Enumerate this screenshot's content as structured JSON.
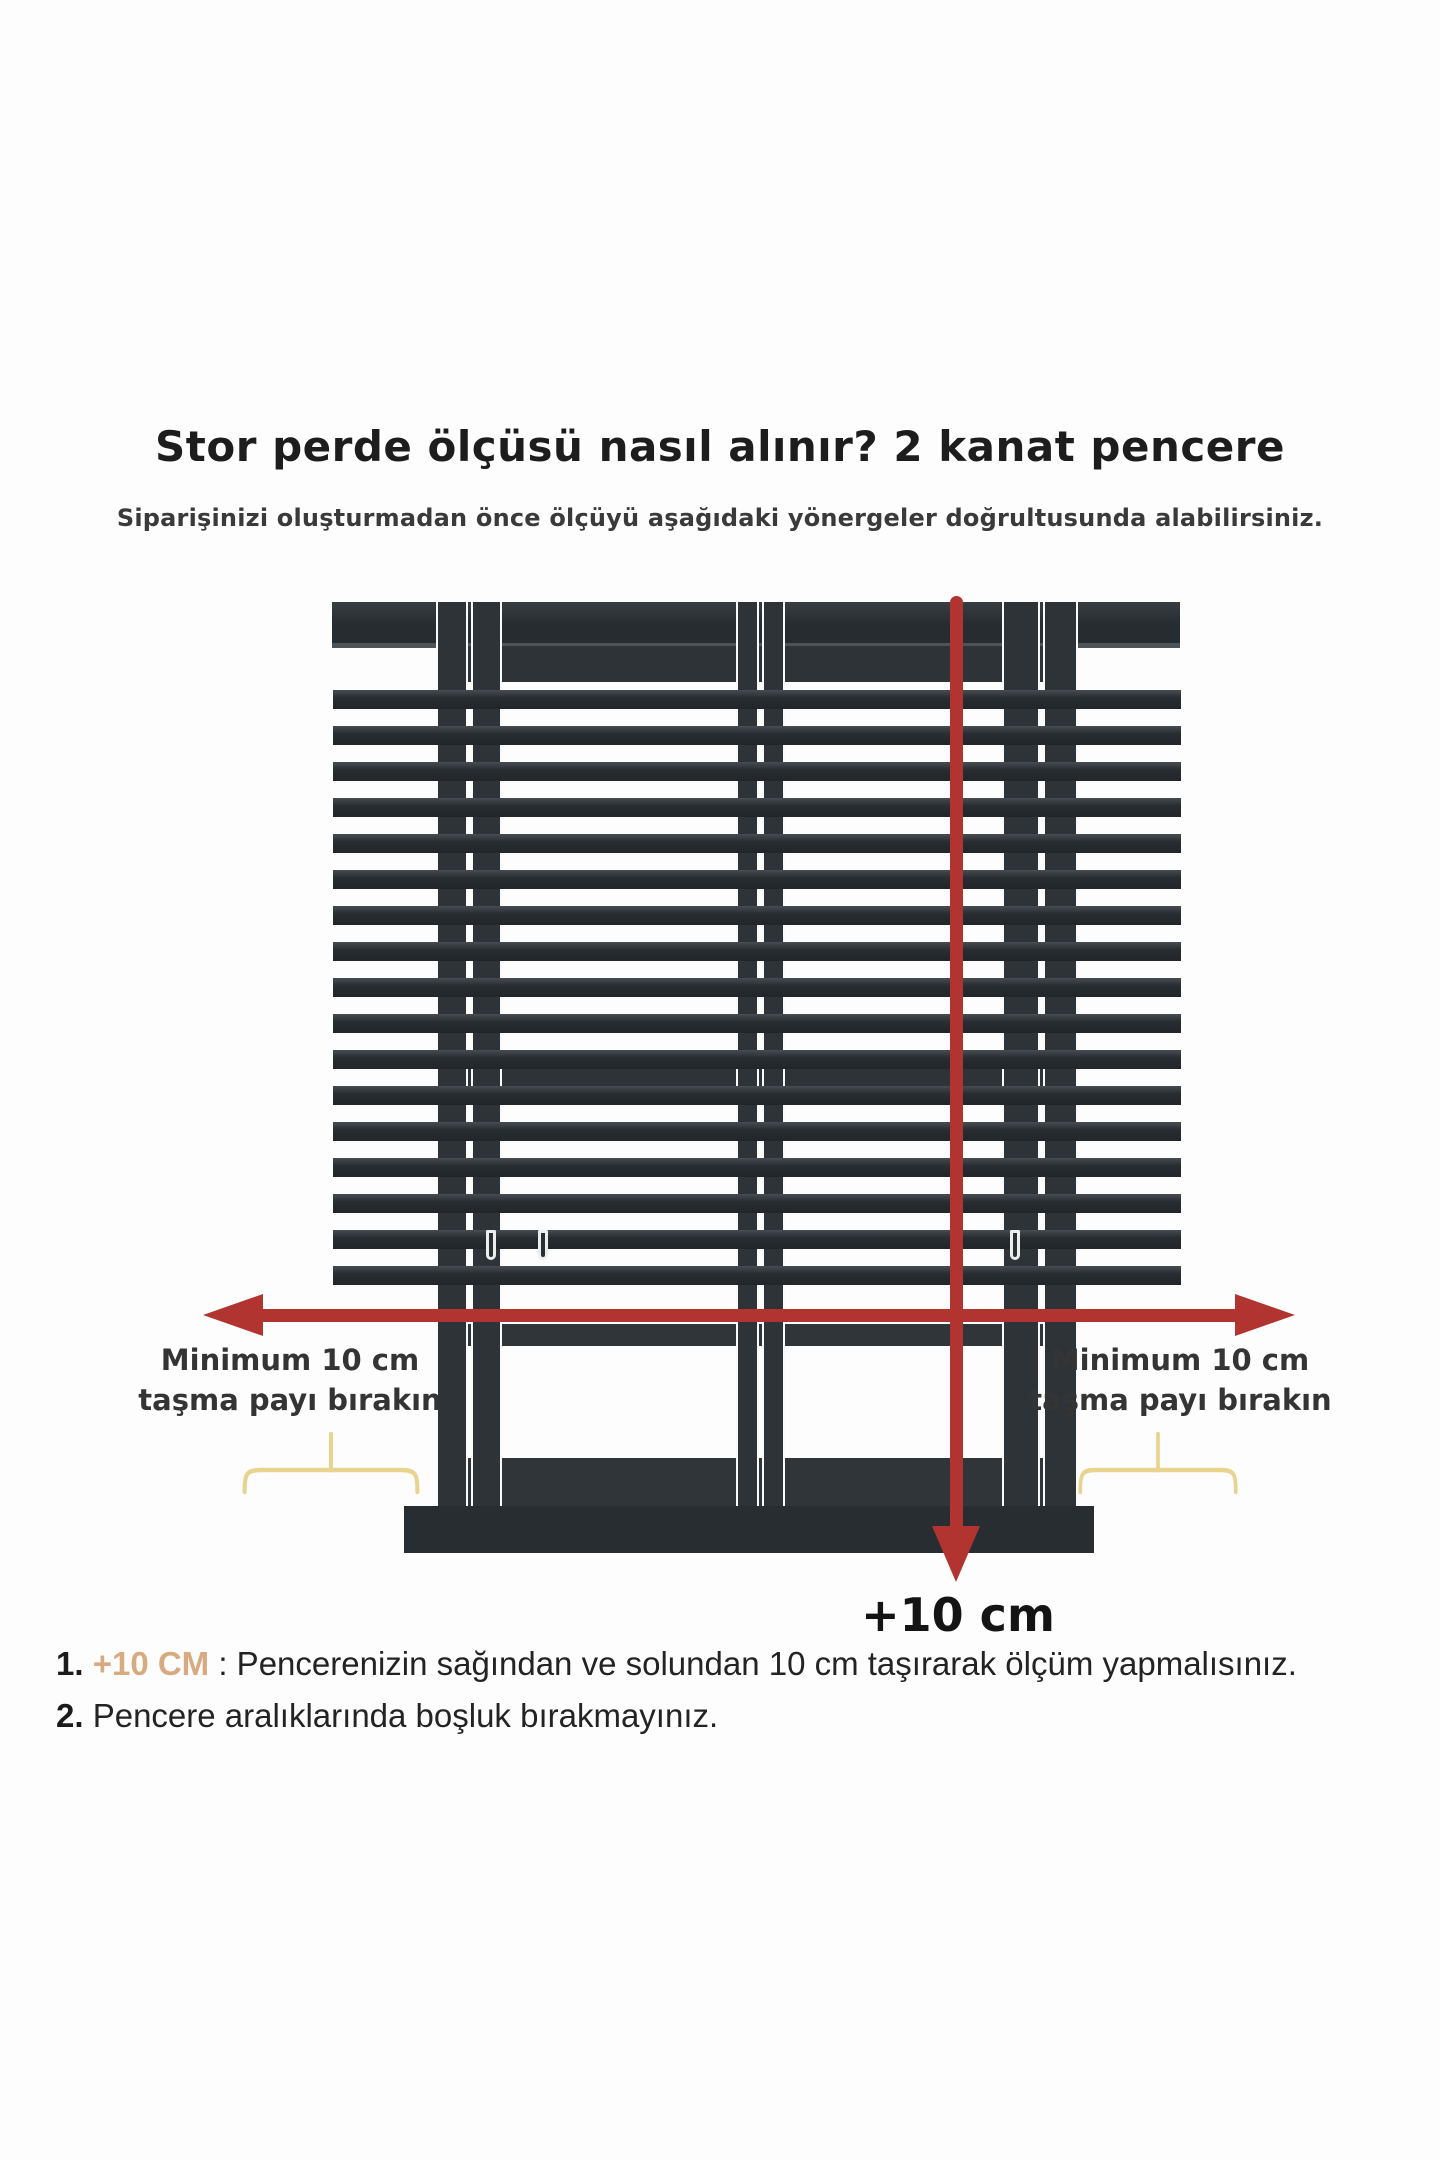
{
  "header": {
    "title": "Stor perde ölçüsü nasıl alınır? 2 kanat pencere",
    "subtitle": "Siparişinizi oluşturmadan önce ölçüyü aşağıdaki yönergeler doğrultusunda alabilirsiniz."
  },
  "diagram": {
    "left_label": {
      "line1": "Minimum 10 cm",
      "line2": "taşma payı bırakın"
    },
    "right_label": {
      "line1": "Minimum 10 cm",
      "line2": "taşma payı bırakın"
    },
    "bottom_arrow_label": "+10 cm",
    "colors": {
      "blind_dark": "#282d31",
      "frame_dark": "#2e3337",
      "red": "#b13430",
      "brace_yellow": "#e8d38f",
      "note_highlight": "#d8aa7f",
      "text_primary": "#1d1d1d",
      "text_secondary": "#3a3a3a"
    }
  },
  "notes": [
    {
      "number": "1.",
      "highlight": "+10 CM",
      "text": " : Pencerenizin sağından ve solundan 10 cm taşırarak ölçüm yapmalısınız."
    },
    {
      "number": "2.",
      "highlight": "",
      "text": " Pencere aralıklarında boşluk bırakmayınız."
    }
  ]
}
